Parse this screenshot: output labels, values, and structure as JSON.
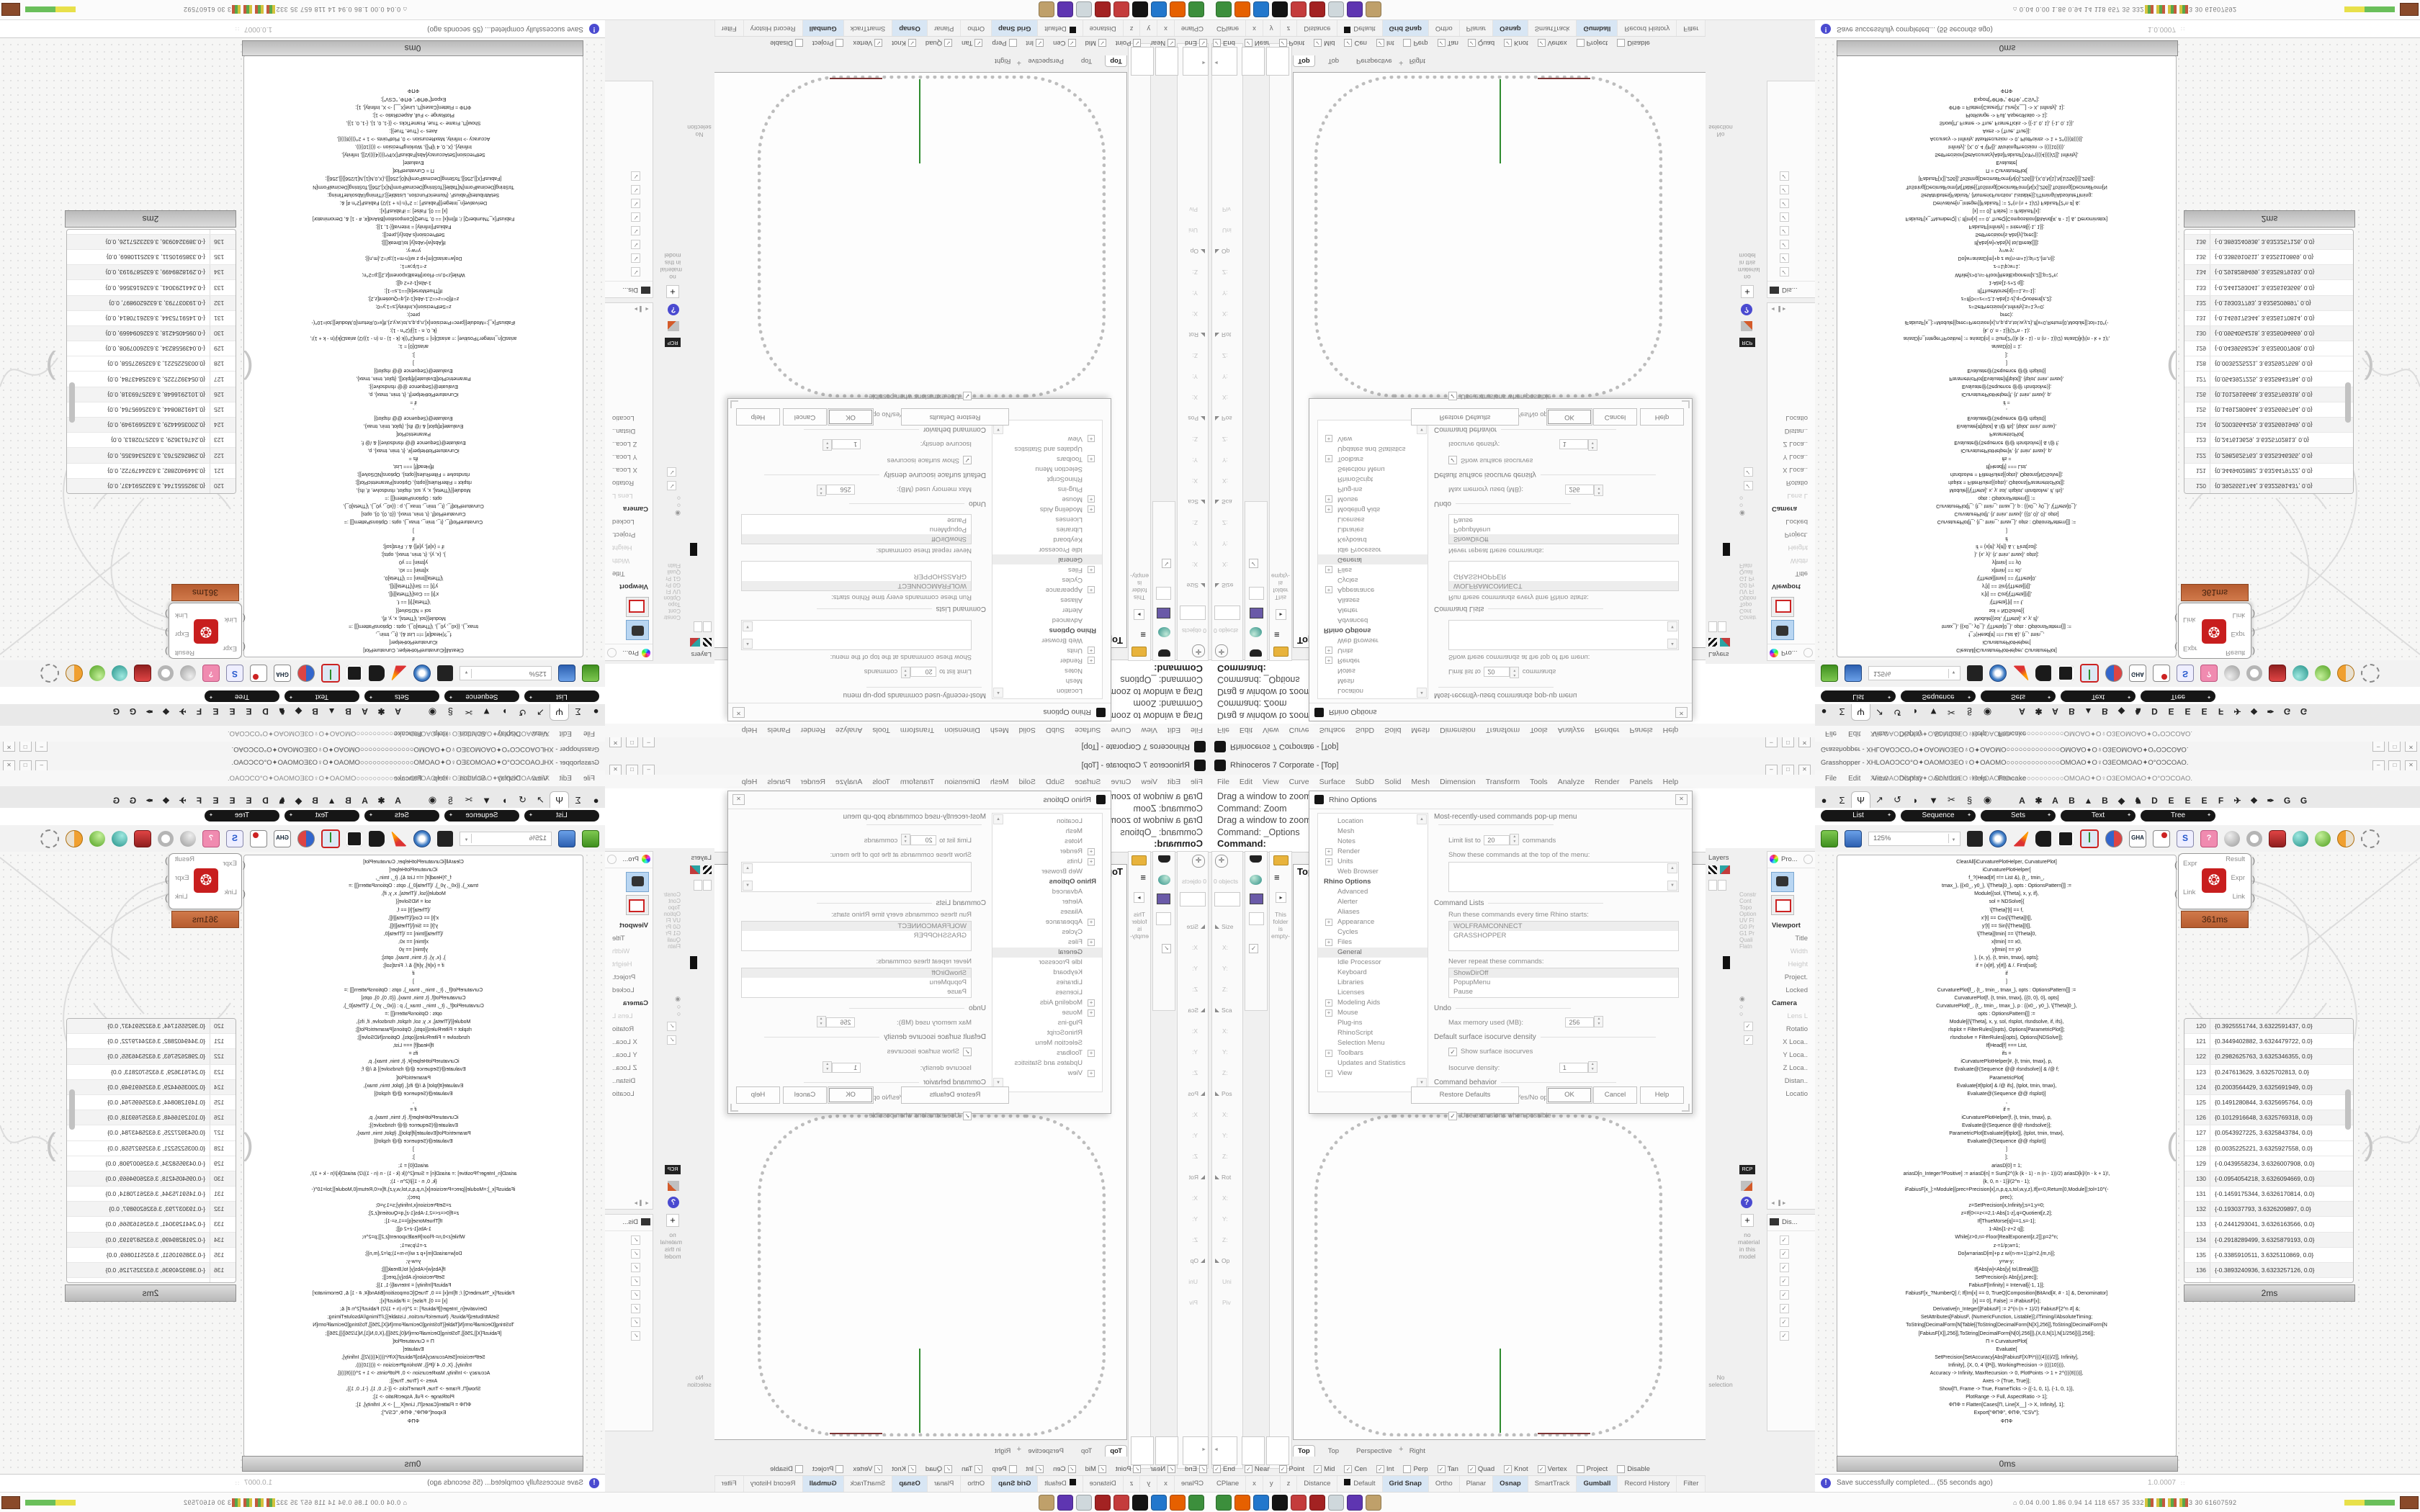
{
  "rhino": {
    "title": "Rhinoceros 7 Corporate - [Top]",
    "window_buttons": {
      "minimize": "–",
      "maximize": "□",
      "close": "✕"
    },
    "menus": [
      "File",
      "Edit",
      "View",
      "Curve",
      "Surface",
      "SubD",
      "Solid",
      "Mesh",
      "Dimension",
      "Transform",
      "Tools",
      "Analyze",
      "Render",
      "Panels",
      "Help"
    ],
    "command_history": [
      "Drag a window to zoom (",
      "Command: Zoom",
      "Drag a window to zoom (",
      "Command: _Options"
    ],
    "command_prompt": "Command:",
    "left_dock": {
      "objects_count": "0 objects",
      "empty_note": "This folder is empty-",
      "properties": [
        {
          "label": "Size",
          "h": 1
        },
        {
          "label": "X:"
        },
        {
          "label": "Y:"
        },
        {
          "label": "Z:"
        },
        {
          "label": "Sca",
          "h": 1
        },
        {
          "label": "X:"
        },
        {
          "label": "Y:"
        },
        {
          "label": "Z:"
        },
        {
          "label": "Pos",
          "h": 1
        },
        {
          "label": "X:"
        },
        {
          "label": "Y:"
        },
        {
          "label": "Z:"
        },
        {
          "label": "Rot",
          "h": 1
        },
        {
          "label": "X:"
        },
        {
          "label": "Y:"
        },
        {
          "label": "Z:"
        },
        {
          "label": "Op",
          "h": 1
        },
        {
          "label": "Uni"
        },
        {
          "label": "Piv"
        }
      ]
    },
    "viewport": {
      "label": "Top",
      "tabs": [
        "Top",
        "Top",
        "Perspective",
        "Right"
      ],
      "new_view_glyph": "+",
      "curve_color": "#bdbdbd",
      "axis_green": "#2e8b2e",
      "axis_red": "#7d3434"
    },
    "osnap": [
      {
        "label": "End",
        "c": 1
      },
      {
        "label": "Near",
        "c": 1
      },
      {
        "label": "Point",
        "c": 1
      },
      {
        "label": "Mid",
        "c": 1
      },
      {
        "label": "Cen",
        "c": 1
      },
      {
        "label": "Int",
        "c": 1
      },
      {
        "label": "Perp"
      },
      {
        "label": "Tan",
        "c": 1
      },
      {
        "label": "Quad",
        "c": 1
      },
      {
        "label": "Knot",
        "c": 1
      },
      {
        "label": "Vertex",
        "c": 1
      },
      {
        "label": "Project"
      },
      {
        "label": "Disable"
      }
    ],
    "status_cells": [
      {
        "label": "CPlane"
      },
      {
        "label": "x"
      },
      {
        "label": "y"
      },
      {
        "label": "z"
      },
      {
        "label": "Distance"
      },
      {
        "label": "Default",
        "sw": 1
      },
      {
        "label": "Grid Snap",
        "a": 1
      },
      {
        "label": "Ortho"
      },
      {
        "label": "Planar"
      },
      {
        "label": "Osnap",
        "a": 1
      },
      {
        "label": "SmartTrack"
      },
      {
        "label": "Gumball",
        "a": 1
      },
      {
        "label": "Record History"
      },
      {
        "label": "Filter"
      }
    ],
    "options_dialog": {
      "title": "Rhino Options",
      "tree": [
        {
          "label": "Location"
        },
        {
          "label": "Mesh"
        },
        {
          "label": "Notes"
        },
        {
          "label": "Render",
          "plus": 1
        },
        {
          "label": "Units",
          "plus": 1
        },
        {
          "label": "Web Browser"
        },
        {
          "label": "Rhino Options",
          "strong": 1
        },
        {
          "label": "Advanced"
        },
        {
          "label": "Alerter"
        },
        {
          "label": "Aliases"
        },
        {
          "label": "Appearance",
          "plus": 1
        },
        {
          "label": "Cycles"
        },
        {
          "label": "Files",
          "plus": 1
        },
        {
          "label": "General",
          "sel": 1
        },
        {
          "label": "Idle Processor"
        },
        {
          "label": "Keyboard"
        },
        {
          "label": "Libraries"
        },
        {
          "label": "Licenses"
        },
        {
          "label": "Modeling Aids",
          "plus": 1
        },
        {
          "label": "Mouse",
          "plus": 1
        },
        {
          "label": "Plug-ins"
        },
        {
          "label": "RhinoScript"
        },
        {
          "label": "Selection Menu"
        },
        {
          "label": "Toolbars",
          "plus": 1
        },
        {
          "label": "Updates and Statistics"
        },
        {
          "label": "View",
          "plus": 1
        }
      ],
      "group_mru": "Most-recently-used commands pop-up menu",
      "limit_label": "Limit list to",
      "limit_value": "20",
      "limit_suffix": "commands",
      "show_top_label": "Show these commands at the top of the menu:",
      "group_cmdlists": "Command Lists",
      "run_label": "Run these commands every time Rhino starts:",
      "run_items": [
        "WOLFRAMCONNECT",
        "GRASSHOPPER"
      ],
      "never_label": "Never repeat these commands:",
      "never_items": [
        "ShowDirOff",
        "PopupMenu",
        "Pause"
      ],
      "group_undo": "Undo",
      "undo_label": "Max memory used (MB):",
      "undo_value": "256",
      "group_iso": "Default surface isocurve density",
      "iso_check": "Show surface isocurves",
      "iso_label": "Isocurve density:",
      "iso_value": "1",
      "group_cmdbehavior": "Command behavior",
      "behavior_checks": [
        "Remember Copy=Yes/No options",
        "Use extrusions when possible"
      ],
      "buttons": {
        "restore": "Restore Defaults",
        "ok": "OK",
        "cancel": "Cancel",
        "help": "Help"
      }
    },
    "right_dock": {
      "layers_label": "Layers",
      "no_selection": "No selection",
      "pro_label": "Pro...",
      "display_label": "Dis...",
      "viewport_props": [
        {
          "label": "Viewport",
          "s": 1
        },
        {
          "label": "Title"
        },
        {
          "label": "Width",
          "g": 1
        },
        {
          "label": "Height",
          "g": 1
        },
        {
          "label": "Project."
        },
        {
          "label": "Locked"
        },
        {
          "label": "Camera",
          "s": 1
        },
        {
          "label": "Lens L",
          "g": 1
        },
        {
          "label": "Rotatio"
        },
        {
          "label": "X Loca.."
        },
        {
          "label": "Y Loca.."
        },
        {
          "label": "Z Loca.."
        },
        {
          "label": "Distan.."
        },
        {
          "label": "Locatio"
        }
      ],
      "side_labels": [
        "Constr",
        "Cont",
        "Topo",
        "Option",
        "UV Fl",
        "G0 Pr",
        "G1 Pr",
        "Quali",
        "Flatn"
      ],
      "rcp_label": "RCP",
      "no_material": "no material in this model"
    }
  },
  "grasshopper": {
    "title": "Grasshopper - XHLOAOƆCO°O✦OAOMO3EO♀O✦OAOMO○○○○○○○○○○○○○OMOAO✦O♀O3EOMOAO✦O°OƆCOAO.",
    "doc_name": "XHLOAOƆCO°O✦OAOMO3EO♀O✦OAOMO○○○○○○○○○○○○○OMOAO✦O♀O3EOMOAO✦O°OƆCOAO.",
    "window_buttons": {
      "minimize": "–",
      "maximize": "□",
      "close": "✕"
    },
    "menus": [
      "File",
      "Edit",
      "View",
      "Display",
      "Solution",
      "Help",
      "Pancake"
    ],
    "tab_glyphs": [
      "●",
      "Σ",
      "Ψ",
      "↗",
      "↺",
      "◗",
      "▼",
      "✂",
      "§",
      "◉"
    ],
    "tab_letters": [
      "A",
      "✱",
      "A",
      "B",
      "▲",
      "B",
      "◆",
      "♞",
      "D",
      "E",
      "E",
      "E",
      "F",
      "✈",
      "❖",
      "✒",
      "G",
      "G"
    ],
    "category_pills": [
      "List",
      "Sequence",
      "Sets",
      "Text",
      "Tree"
    ],
    "zoom_level": "125%",
    "gha_label": "GHA",
    "code_panel_label": "0ms",
    "table_panel_label": "2ms",
    "expr_profiler": "361ms",
    "expr_component": {
      "in1": "Expr",
      "in2": "Link",
      "out1": "Result",
      "out2": "Expr",
      "out3": "Link"
    },
    "code_lines": [
      "ClearAll[iCurvaturePlotHelper, CurvaturePlot]",
      "iCurvaturePlotHelper[",
      "f_?(Head[#] =!= List &), {t_, tmin_,",
      "tmax_}, {{x0_, y0_}, \\[Theta]0_}, opts : OptionsPattern[]] :=",
      "Module[{sol, \\[Theta], x, y, if},",
      "sol = NDSolve[{",
      "\\[Theta]'[t] == f,",
      "x'[t] == Cos[\\[Theta][t]],",
      "y'[t] == Sin[\\[Theta][t]],",
      "\\[Theta][tmin] == \\[Theta]0,",
      "x[tmin] == x0,",
      "y[tmin] == y0",
      "}, {x, y}, {t, tmin, tmax}, opts];",
      "if = {x[#], y[#]} & /. First[sol];",
      "if",
      "]",
      "CurvaturePlot[f_, {t_, tmin_, tmax_}, opts : OptionsPattern[]] :=",
      "CurvaturePlot[f, {t, tmin, tmax}, {{0, 0}, 0}, opts]",
      "CurvaturePlot[f_, {t_, tmin_, tmax_}, p : {{x0_, y0_}, \\[Theta]0_},",
      "opts : OptionsPattern[]] :=",
      "Module[{\\[Theta], x, y, sol, rlsplot, rlsndsolve, if, ifs},",
      "rlsplot = FilterRules[{opts}, Options[ParametricPlot]];",
      "rlsndsolve = FilterRules[{opts}, Options[NDSolve]];",
      "If[Head[f] === List,",
      "ifs =",
      "iCurvaturePlotHelper[#, {t, tmin, tmax}, p,",
      "Evaluate@(Sequence @@ rlsndsolve)] & /@ f;",
      "ParametricPlot[",
      "Evaluate[#[tplot] & /@ ifs], {tplot, tmin, tmax},",
      "Evaluate@(Sequence @@ rlsplot)]",
      ",",
      "if =",
      "iCurvaturePlotHelper[f, {t, tmin, tmax}, p,",
      "Evaluate@(Sequence @@ rlsndsolve)];",
      "ParametricPlot[Evaluate[if[tplot]], {tplot, tmin, tmax},",
      "Evaluate@(Sequence @@ rlsplot)]",
      "]",
      "];",
      "",
      "ariasD[0] = 1;",
      "ariasD[n_Integer?Positive] := ariasD[n] = Sum[2^((k (k - 1) - n (n - 1))/2) ariasD[k]/(n - k + 1)!,",
      "{k, 0, n - 1}]/(2^n - 1);",
      "iFabiusF[x_]:=Module[{prec=Precision[x],n,p,q,s,tol,w,y,z},If[x<0,Return[0,Module]];tol=10^(-",
      "prec);",
      "z=SetPrecision[x,Infinity];s=1;y=0;",
      "z=If[0<=z<=2,1-Abs[1-z],q=Quotient[z,2];",
      "If[ThueMorse[q]==1,s=-1];",
      "1-Abs[1-z+2 q]];",
      "While[z>0,n=-Floor[RealExponent[z,2]];p=2^n;",
      "z-=1/p;w=1;",
      "Do[w=ariasD[m]+p z w/(n-m+1);p/=2,{m,n}];",
      "y=w-y;",
      "If[Abs[w]<Abs[y] tol,Break[]]];",
      "SetPrecision[s Abs[y],prec]];",
      "FabiusF[Infinity] = Interval[{-1, 1}];",
      "FabiusF[x_?NumberQ] /; If[Im[x] == 0, TrueQ[Composition[BitAnd[#, # - 1] &, Denominator]",
      "[x] == 0], False] := iFabiusF[x];",
      "Derivative[n_Integer][FabiusF] := 2^(n (n + 1)/2) FabiusF[2^n #] &;",
      "SetAttributes[FabiusF, {NumericFunction, Listable}];//Timing//AbsoluteTiming;",
      "",
      "ToString[DecimalForm[N[Table[{ToString[DecimalForm[N[X],256]],ToString[DecimalForm[N",
      "[FabiusF[X]],256]],ToString[DecimalForm[N[0],256]]},{X,0,N[1],N[1/256]}]],256]];",
      "",
      "Π = CurvaturePlot[",
      "Evaluate[",
      "SetPrecision[SetAccuracy[Abs[FabiusF[X/Pi*((((4))))/2]], Infinity],",
      "Infinity], {X, 0, 4 \\[Pi]}, WorkingPrecision -> ((((10)))),",
      "Accuracy -> Infinity, MaxRecursion -> 0, PlotPoints -> 1 + 2^((((8))))],",
      "Axes -> {True, True}];",
      "Show[Π, Frame -> True, FrameTicks -> {{-1, 0, 1}, {-1, 0, 1}},",
      "PlotRange -> Full, AspectRatio -> 1];",
      "ΦΠΦ = Flatten[Cases[Π, Line[X__] -> X, Infinity], 1];",
      "Export[\"ΦΠΦ\", ΦΠΦ, \"CSV\"];",
      "ΦΠΦ"
    ],
    "table_rows": [
      {
        "n": "120",
        "v": "{0.3925551744, 3.6322591437, 0.0}"
      },
      {
        "n": "121",
        "v": "{0.3449402882, 3.6324479722, 0.0}"
      },
      {
        "n": "122",
        "v": "{0.2982625763, 3.6325346355, 0.0}"
      },
      {
        "n": "123",
        "v": "{0.247613629, 3.6325702813, 0.0}"
      },
      {
        "n": "124",
        "v": "{0.2003564429, 3.6325691949, 0.0}"
      },
      {
        "n": "125",
        "v": "{0.1491280844, 3.6325695764, 0.0}"
      },
      {
        "n": "126",
        "v": "{0.1012916648, 3.6325769318, 0.0}"
      },
      {
        "n": "127",
        "v": "{0.0543927225, 3.6325843784, 0.0}"
      },
      {
        "n": "128",
        "v": "{0.0035225221, 3.6325927558, 0.0}",
        "hl": 1
      },
      {
        "n": "129",
        "v": "{-0.0439558234, 3.6326007908, 0.0}"
      },
      {
        "n": "130",
        "v": "{-0.0954054218, 3.6326094669, 0.0}"
      },
      {
        "n": "131",
        "v": "{-0.1459175344, 3.6326170814, 0.0}"
      },
      {
        "n": "132",
        "v": "{-0.193037793, 3.6326209897, 0.0}"
      },
      {
        "n": "133",
        "v": "{-0.2441293041, 3.6326163566, 0.0}"
      },
      {
        "n": "134",
        "v": "{-0.2918289499, 3.6325879193, 0.0}"
      },
      {
        "n": "135",
        "v": "{-0.3385910511, 3.6325110869, 0.0}"
      },
      {
        "n": "136",
        "v": "{-0.3893240936, 3.6323257126, 0.0}"
      },
      {
        "n": "137",
        "v": "{-0.4366640544, 3.6249882257, 0.0}"
      }
    ],
    "status": {
      "message": "Save successfully completed... (55 seconds ago)",
      "version": "1.0.0007"
    }
  },
  "taskbar": {
    "monitor_text": "⌂  0.04 0.00 1.86 0.94   14   118   657   35   332   287   3.0   6.1   33   30   61607592",
    "icons": [
      {
        "name": "terminal",
        "bg": "#3c8f3c"
      },
      {
        "name": "firefox",
        "bg": "#e66000"
      },
      {
        "name": "floppy-save",
        "bg": "#2277cc"
      },
      {
        "name": "rhino-app",
        "bg": "#141414"
      },
      {
        "name": "gear-red-1",
        "bg": "#c43c3c"
      },
      {
        "name": "gear-red-2",
        "bg": "#a32222"
      },
      {
        "name": "notepad",
        "bg": "#cfd8dc"
      },
      {
        "name": "owl-app",
        "bg": "#5e35b1"
      },
      {
        "name": "palette",
        "bg": "#bfa06a"
      }
    ]
  }
}
